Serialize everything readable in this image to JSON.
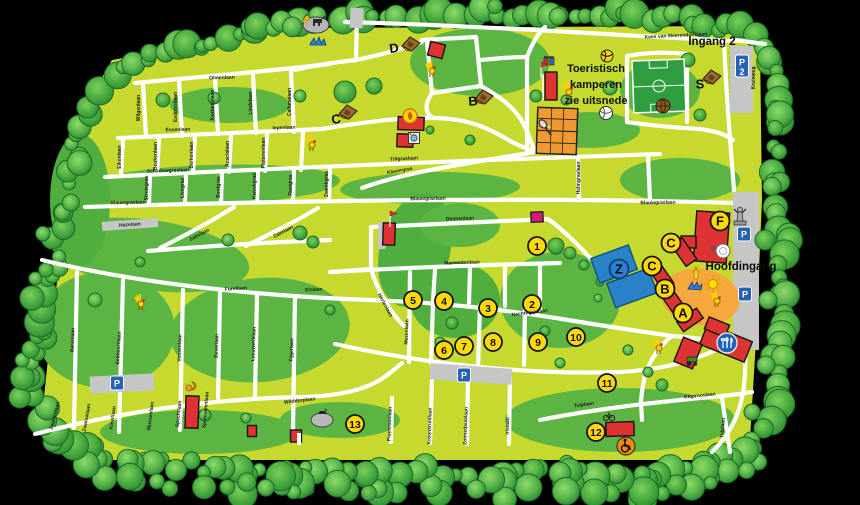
{
  "map": {
    "entrance_labels": [
      {
        "text": "Ingang 2",
        "x": 712,
        "y": 45
      },
      {
        "text": "Hoofdingang",
        "x": 741,
        "y": 270
      }
    ],
    "note": {
      "lines": [
        "Toeristisch",
        "kamperen",
        "zie uitsnede"
      ],
      "x": 596,
      "y": 72,
      "line_height": 16
    },
    "colors": {
      "field": "#c6d92f",
      "patch": "#5cb542",
      "patch_dark": "#4fae3e",
      "tree_edge": "#1d6b26",
      "road": "#ffffff",
      "building": "#dd3333",
      "building_edge": "#141414",
      "marker_fill": "#ffd903",
      "marker_edge": "#141414",
      "z_marker": "#2b7fd0",
      "parking_sign": "#2563b0",
      "parking_lot": "#c6c6c6",
      "court": "#ef9930",
      "pitch": "#2f9e41",
      "playground": "#f6a83c",
      "pool": "#2a82c8",
      "magenta": "#d6187f",
      "water": "#2a7fd4"
    },
    "letter_markers": [
      {
        "label": "D",
        "x": 394,
        "y": 48,
        "style": "plain",
        "rot": -8
      },
      {
        "label": "C",
        "x": 336,
        "y": 119,
        "style": "plain",
        "rot": -8
      },
      {
        "label": "B",
        "x": 473,
        "y": 101,
        "style": "plain",
        "rot": -5
      },
      {
        "label": "S",
        "x": 700,
        "y": 84,
        "style": "plain",
        "rot": 0
      },
      {
        "label": "F",
        "x": 720,
        "y": 221,
        "style": "circle",
        "rot": 0
      },
      {
        "label": "C",
        "x": 671,
        "y": 243,
        "style": "circle",
        "rot": 0
      },
      {
        "label": "C",
        "x": 652,
        "y": 266,
        "style": "circle",
        "rot": 0
      },
      {
        "label": "B",
        "x": 665,
        "y": 289,
        "style": "circle",
        "rot": 0
      },
      {
        "label": "A",
        "x": 683,
        "y": 313,
        "style": "circle",
        "rot": 0
      },
      {
        "label": "Z",
        "x": 619,
        "y": 269,
        "style": "blue",
        "rot": 0
      }
    ],
    "number_markers": [
      {
        "label": "1",
        "x": 537,
        "y": 246
      },
      {
        "label": "2",
        "x": 532,
        "y": 304
      },
      {
        "label": "3",
        "x": 488,
        "y": 308
      },
      {
        "label": "4",
        "x": 444,
        "y": 301
      },
      {
        "label": "5",
        "x": 413,
        "y": 300
      },
      {
        "label": "6",
        "x": 444,
        "y": 350
      },
      {
        "label": "7",
        "x": 464,
        "y": 346
      },
      {
        "label": "8",
        "x": 493,
        "y": 342
      },
      {
        "label": "9",
        "x": 538,
        "y": 342
      },
      {
        "label": "10",
        "x": 576,
        "y": 337
      },
      {
        "label": "11",
        "x": 607,
        "y": 383
      },
      {
        "label": "12",
        "x": 596,
        "y": 432
      },
      {
        "label": "13",
        "x": 355,
        "y": 424
      }
    ],
    "parking_signs": [
      {
        "label": "P",
        "sub": "",
        "x": 117,
        "y": 383
      },
      {
        "label": "P",
        "sub": "",
        "x": 464,
        "y": 375
      },
      {
        "label": "P",
        "sub": "",
        "x": 744,
        "y": 234
      },
      {
        "label": "P",
        "sub": "",
        "x": 745,
        "y": 294
      },
      {
        "label": "P",
        "sub": "2",
        "x": 742,
        "y": 62
      }
    ],
    "streets": [
      {
        "t": "Olmenlaan",
        "x": 222,
        "y": 79,
        "r": -2
      },
      {
        "t": "Essenlaan",
        "x": 178,
        "y": 131,
        "r": -2
      },
      {
        "t": "Iepenlaan",
        "x": 284,
        "y": 129,
        "r": -2
      },
      {
        "t": "Wilgenlaan",
        "x": 140,
        "y": 108,
        "r": -90
      },
      {
        "t": "Esdoornlaan",
        "x": 177,
        "y": 107,
        "r": -90
      },
      {
        "t": "Kastanjelaan",
        "x": 214,
        "y": 105,
        "r": -90
      },
      {
        "t": "Lindelaan",
        "x": 252,
        "y": 103,
        "r": -90
      },
      {
        "t": "Callunalaan",
        "x": 291,
        "y": 102,
        "r": -90
      },
      {
        "t": "Eikenlaan",
        "x": 121,
        "y": 157,
        "r": -90
      },
      {
        "t": "Beukenlaan",
        "x": 157,
        "y": 156,
        "r": -90
      },
      {
        "t": "Berkenlaan",
        "x": 193,
        "y": 155,
        "r": -90
      },
      {
        "t": "Acacialaan",
        "x": 229,
        "y": 154,
        "r": -90
      },
      {
        "t": "Platanenlaan",
        "x": 265,
        "y": 153,
        "r": -90
      },
      {
        "t": "Schaduwgraslaan",
        "x": 168,
        "y": 172,
        "r": -2
      },
      {
        "t": "Trilgraslaan",
        "x": 404,
        "y": 160,
        "r": -3
      },
      {
        "t": "Klavergras",
        "x": 400,
        "y": 172,
        "r": -10
      },
      {
        "t": "Blauwgraslaan",
        "x": 128,
        "y": 204,
        "r": -1
      },
      {
        "t": "Blauwgraslaan",
        "x": 428,
        "y": 200,
        "r": -1
      },
      {
        "t": "Blauwgraslaan",
        "x": 658,
        "y": 204,
        "r": -1
      },
      {
        "t": "Struisgras",
        "x": 148,
        "y": 188,
        "r": -90
      },
      {
        "t": "Liesgras",
        "x": 184,
        "y": 188,
        "r": -90
      },
      {
        "t": "Bentgras",
        "x": 220,
        "y": 187,
        "r": -90
      },
      {
        "t": "Kweekgras",
        "x": 256,
        "y": 186,
        "r": -90
      },
      {
        "t": "Raaigras",
        "x": 292,
        "y": 185,
        "r": -90
      },
      {
        "t": "Zwenkgras",
        "x": 328,
        "y": 184,
        "r": -90
      },
      {
        "t": "Helmgraslaan",
        "x": 580,
        "y": 178,
        "r": -90
      },
      {
        "t": "Hazelaan",
        "x": 130,
        "y": 226,
        "r": -4
      },
      {
        "t": "Zalmlaan",
        "x": 200,
        "y": 236,
        "r": -28
      },
      {
        "t": "Zalmlaan",
        "x": 284,
        "y": 233,
        "r": -28
      },
      {
        "t": "Forellaan",
        "x": 236,
        "y": 290,
        "r": -4
      },
      {
        "t": "Elslaan",
        "x": 314,
        "y": 291,
        "r": -3
      },
      {
        "t": "Dennenlaan",
        "x": 460,
        "y": 220,
        "r": -2
      },
      {
        "t": "Marmottenlaan",
        "x": 462,
        "y": 264,
        "r": -2
      },
      {
        "t": "Hertenlaan",
        "x": 384,
        "y": 306,
        "r": 62
      },
      {
        "t": "Nachtegaallaan",
        "x": 530,
        "y": 314,
        "r": -7
      },
      {
        "t": "Berenlaan",
        "x": 74,
        "y": 340,
        "r": -88
      },
      {
        "t": "Eekhoornlaan",
        "x": 120,
        "y": 348,
        "r": -87
      },
      {
        "t": "Vossenlaan",
        "x": 181,
        "y": 348,
        "r": -88
      },
      {
        "t": "Beverlaan",
        "x": 218,
        "y": 346,
        "r": -88
      },
      {
        "t": "Leeuweriklaan",
        "x": 255,
        "y": 344,
        "r": -88
      },
      {
        "t": "Tijgerlaan",
        "x": 293,
        "y": 350,
        "r": -88
      },
      {
        "t": "Mezenlaan",
        "x": 408,
        "y": 332,
        "r": -88
      },
      {
        "t": "Wilddorplaan",
        "x": 300,
        "y": 402,
        "r": -7
      },
      {
        "t": "Zwanenlaan",
        "x": 56,
        "y": 416,
        "r": -75
      },
      {
        "t": "Zwaluwlaan",
        "x": 88,
        "y": 418,
        "r": -80
      },
      {
        "t": "Kievitlaan",
        "x": 114,
        "y": 418,
        "r": -82
      },
      {
        "t": "Mussenlaan",
        "x": 152,
        "y": 416,
        "r": -83
      },
      {
        "t": "Spechtlaan",
        "x": 180,
        "y": 414,
        "r": -84
      },
      {
        "t": "Spreeuwenlaan",
        "x": 207,
        "y": 410,
        "r": -85
      },
      {
        "t": "Pioenrooslaan",
        "x": 391,
        "y": 424,
        "r": -88
      },
      {
        "t": "Kroonkruidlaan",
        "x": 431,
        "y": 426,
        "r": -88
      },
      {
        "t": "Zonnedauwlaan",
        "x": 467,
        "y": 426,
        "r": -88
      },
      {
        "t": "Irislaan",
        "x": 509,
        "y": 426,
        "r": -88
      },
      {
        "t": "Tulplaan",
        "x": 584,
        "y": 406,
        "r": -8
      },
      {
        "t": "Klaprooslaan",
        "x": 700,
        "y": 397,
        "r": -6
      },
      {
        "t": "Tulplaan",
        "x": 724,
        "y": 428,
        "r": -85
      },
      {
        "t": "Kees van Meerendonklaan",
        "x": 676,
        "y": 37,
        "r": -3
      },
      {
        "t": "Kruinweg",
        "x": 755,
        "y": 78,
        "r": -90
      }
    ],
    "icons": [
      {
        "type": "petting-zoo",
        "x": 316,
        "y": 22
      },
      {
        "type": "water-splash",
        "x": 318,
        "y": 42
      },
      {
        "type": "hut",
        "x": 411,
        "y": 44
      },
      {
        "type": "hut",
        "x": 348,
        "y": 112
      },
      {
        "type": "hut",
        "x": 484,
        "y": 97
      },
      {
        "type": "hut",
        "x": 712,
        "y": 77
      },
      {
        "type": "rooster",
        "x": 431,
        "y": 70
      },
      {
        "type": "rooster",
        "x": 311,
        "y": 144
      },
      {
        "type": "rooster",
        "x": 568,
        "y": 91
      },
      {
        "type": "rooster",
        "x": 716,
        "y": 300
      },
      {
        "type": "rooster",
        "x": 140,
        "y": 303
      },
      {
        "type": "rooster",
        "x": 658,
        "y": 347
      },
      {
        "type": "fire-badge",
        "x": 410,
        "y": 116
      },
      {
        "type": "washer",
        "x": 414,
        "y": 138
      },
      {
        "type": "playset",
        "x": 549,
        "y": 61
      },
      {
        "type": "volleyball-yellow",
        "x": 607,
        "y": 56
      },
      {
        "type": "volleyball-white",
        "x": 606,
        "y": 113
      },
      {
        "type": "football-brown",
        "x": 663,
        "y": 106
      },
      {
        "type": "tennis-racket",
        "x": 545,
        "y": 128
      },
      {
        "type": "statue",
        "x": 740,
        "y": 216
      },
      {
        "type": "plate-fork",
        "x": 723,
        "y": 251
      },
      {
        "type": "bottle",
        "x": 696,
        "y": 274
      },
      {
        "type": "swim",
        "x": 695,
        "y": 286
      },
      {
        "type": "sun",
        "x": 713,
        "y": 284
      },
      {
        "type": "cutlery-badge",
        "x": 727,
        "y": 343
      },
      {
        "type": "tractor",
        "x": 692,
        "y": 361
      },
      {
        "type": "wheelchair-badge",
        "x": 626,
        "y": 446
      },
      {
        "type": "bike",
        "x": 609,
        "y": 416
      },
      {
        "type": "squirrel",
        "x": 191,
        "y": 387
      },
      {
        "type": "rock-bird",
        "x": 322,
        "y": 418
      },
      {
        "type": "flag-red",
        "x": 390,
        "y": 219
      },
      {
        "type": "flag-red",
        "x": 541,
        "y": 70
      }
    ]
  }
}
